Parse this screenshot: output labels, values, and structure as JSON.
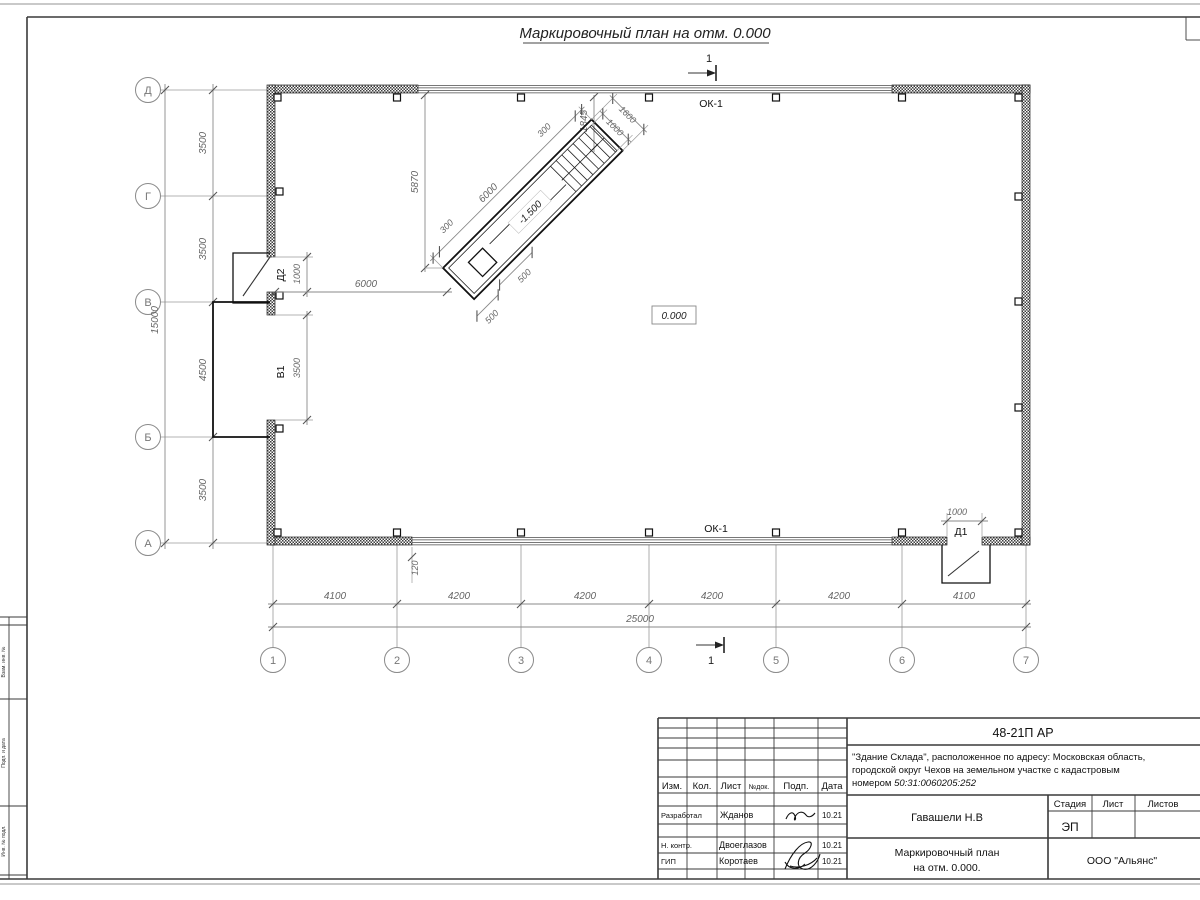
{
  "sheet": {
    "title": "Маркировочный план на отм. 0.000",
    "section_label": "1"
  },
  "plan": {
    "axes_left": [
      "Д",
      "Г",
      "В",
      "Б",
      "А"
    ],
    "axes_bottom": [
      "1",
      "2",
      "3",
      "4",
      "5",
      "6",
      "7"
    ],
    "labels": {
      "ok1": "ОК-1",
      "d1": "Д1",
      "d2": "Д2",
      "v1": "В1",
      "zero": "0.000"
    }
  },
  "dims": {
    "left_chain": [
      "3500",
      "3500",
      "4500",
      "3500"
    ],
    "left_total": "15000",
    "bottom_chain": [
      "4100",
      "4200",
      "4200",
      "4200",
      "4200",
      "4100"
    ],
    "bottom_total": "25000",
    "d2_width": "1000",
    "v1_width": "3500",
    "d1_width": "1000",
    "w120": "120",
    "wall6000": "6000",
    "r5870": "5870",
    "r1845": "1845"
  },
  "ramp": {
    "level": "-1.500",
    "len6000": "6000",
    "r300_sw": "300",
    "r300_ne": "300",
    "w1000": "1000",
    "w1600": "1600",
    "s500_a": "500",
    "s500_b": "500"
  },
  "titleblock": {
    "doc_number": "48-21П АР",
    "project_line1": "\"Здание Склада\", расположенное по адресу: Московская область,",
    "project_line2": "городской округ Чехов на земельном участке с кадастровым",
    "project_line3_prefix": "номером ",
    "project_cadastral": "50:31:0060205:252",
    "cols": {
      "izm": "Изм.",
      "kol": "Кол.",
      "list": "Лист",
      "ndok": "№док.",
      "podp": "Подп.",
      "data": "Дата"
    },
    "rows": [
      {
        "role": "Разработал",
        "name": "Жданов",
        "date": "10.21"
      },
      {
        "role": "Н. контр.",
        "name": "Двоеглазов",
        "date": "10.21"
      },
      {
        "role": "ГИП",
        "name": "Коротаев",
        "date": "10.21"
      }
    ],
    "chief": "Гавашели Н.В",
    "stage_label": "Стадия",
    "sheet_label": "Лист",
    "sheets_label": "Листов",
    "stage": "ЭП",
    "drawing_title_line1": "Маркировочный план",
    "drawing_title_line2": "на отм. 0.000.",
    "company": "ООО \"Альянс\""
  },
  "frame": {
    "left_labels": [
      "Взам. инв. №",
      "Подп. и дата",
      "Инв. № подл."
    ]
  }
}
